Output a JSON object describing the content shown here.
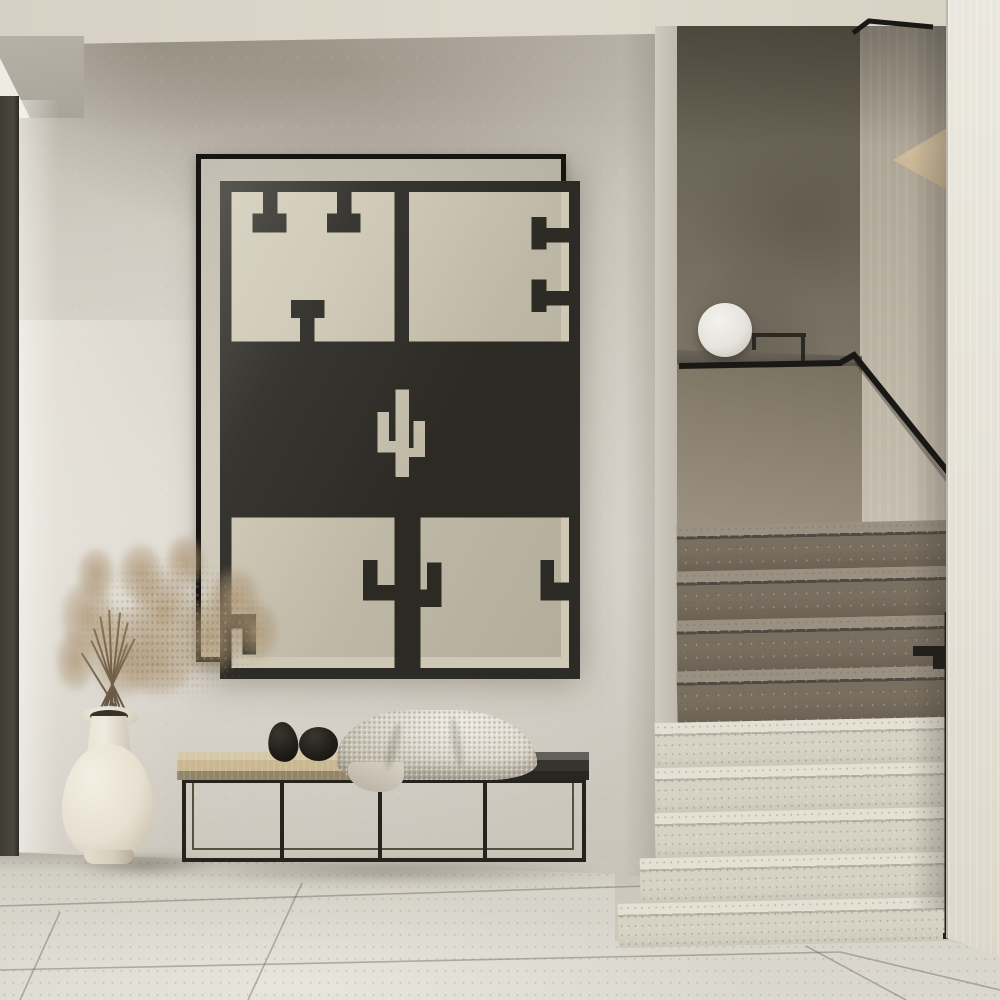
{
  "meta": {
    "type": "photograph",
    "subject": "Minimalist entryway interior with staircase",
    "style": "neutral beige and black palette, textured plaster walls, terrazzo floor"
  },
  "objects": {
    "artwork": {
      "label": "Framed geometric cactus poster",
      "frame": "thin black frame",
      "motif": "black kilim-style geometric pattern with central pixel cactus on cream paper",
      "sections": [
        "top-left panel with hanging T motifs",
        "top-right panel with border brackets",
        "solid black middle band with cream cactus",
        "bottom panels with candelabra-cactus column and corner hooks"
      ]
    },
    "bench": {
      "label": "Low slatted bench with thin black metal frame",
      "top_left": "light oak slab",
      "top_right": "dark stained slab",
      "decor": [
        "black pebble sculpture upright",
        "black pebble sculpture round",
        "cream knitted throw blanket"
      ]
    },
    "vase": {
      "label": "Cream ceramic bottle vase with dried pampas grass"
    },
    "lamp": {
      "label": "White globe lamp on half-wall ledge",
      "accessory": "thin black stand frame"
    },
    "staircase": {
      "label": "Terrazzo staircase with black metal handrail",
      "visible_steps": 9,
      "upper_steps": "shadowed brown terrazzo",
      "lower_steps": "light cream terrazzo",
      "handrail": "black, horizontal over half-wall then descending diagonally",
      "newel": "black post at wall edge with bracket"
    },
    "walls": {
      "label": "Greige textured plaster walls with darker stairwell wall"
    },
    "ceiling": {
      "label": "Cream ceiling band with corner soffit"
    },
    "door": {
      "label": "Dark door frame at left edge"
    },
    "floor": {
      "label": "Large-format light terrazzo floor tiles with diagonal seams"
    }
  },
  "palette": {
    "wall": "#cdc8be",
    "wall_stain": "#8c8175",
    "ceiling": "#dad5c8",
    "stairwell_back_wall": "#77705f",
    "stairwell_side_wall": "#c3bcad",
    "foreground_wall": "#e9e6dd",
    "floor": "#d6d3c9",
    "artwork_paper": "#cfc8b5",
    "artwork_ink": "#2d2b25",
    "frame_black": "#16150f",
    "bench_wood": "#c9b78f",
    "bench_dark_slab": "#37342d",
    "metal_black": "#21201c",
    "step_light": "#d7d2c4",
    "step_brown": "#796f60",
    "vase": "#e7e0d1",
    "pampas": "#b0996f",
    "lamp": "#efede8",
    "pebbles": "#201d18",
    "blanket": "#d7d1c4",
    "door_frame": "#45423a"
  }
}
